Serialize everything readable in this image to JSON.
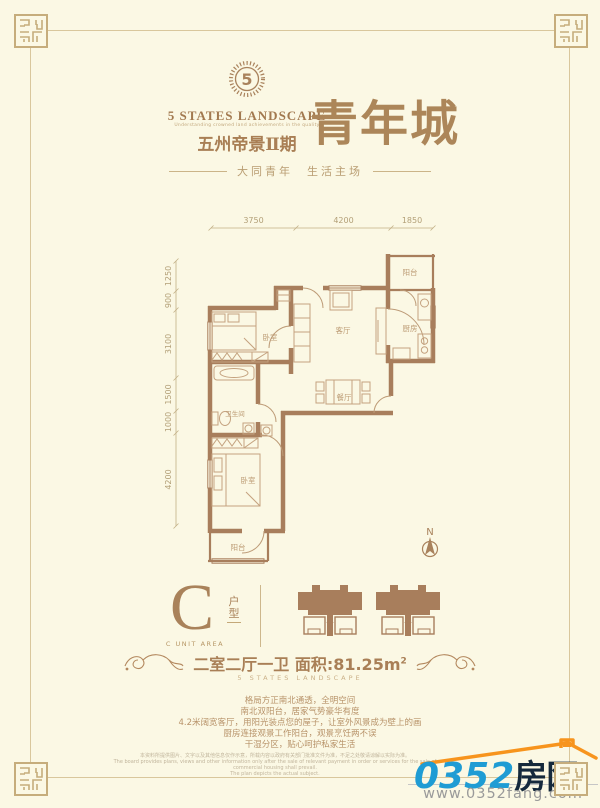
{
  "colors": {
    "background": "#FBF8E4",
    "brand_brown": "#A9825C",
    "wall_brown": "#A87E5C",
    "watermark_blue": "#1F9CD4",
    "watermark_navy": "#15293C",
    "watermark_orange": "#F7941D"
  },
  "header": {
    "logo_glyph": "5",
    "brand": "5 STATES LANDSCAPE",
    "tagline": "Understanding crowned land achievements in the quality",
    "project": "五州帝景Ⅱ期",
    "title": "青年城",
    "subtitle": "大同青年　生活主场"
  },
  "plan": {
    "dims_top": [
      "3750",
      "4200",
      "1850"
    ],
    "dims_left": [
      "1250",
      "900",
      "3100",
      "1500",
      "1000",
      "4200"
    ],
    "rooms": {
      "balcony_top": "阳台",
      "kitchen": "厨房",
      "living": "客厅",
      "bedroom1": "卧室",
      "bath": "卫生间",
      "dining": "餐厅",
      "bedroom2": "卧室",
      "balcony_bottom": "阳台"
    },
    "compass": "N"
  },
  "unit": {
    "letter": "C",
    "type_label": "户型",
    "subtitle": "C UNIT AREA"
  },
  "summary": {
    "spec": "二室二厅一卫",
    "area": "面积:81.25m",
    "area_sup": "2",
    "brand": "5 STATES LANDSCAPE"
  },
  "description": {
    "line1": "格局方正南北通透，全明空间",
    "line2": "南北双阳台，居家气势豪华有度",
    "line3": "4.2米阔宽客厅，用阳光装点您的屋子，让室外风景成为壁上的画",
    "line4": "厨房连接观景工作阳台，观景烹饪两不误",
    "line5": "干湿分区，贴心呵护私家生活"
  },
  "disclaimer": {
    "line1": "本资料所提供图片、文字以及其他信息仅作示意，所载内容以政府有关部门批准文件为准，不足之处敬请谅解以实际为准。",
    "line2": "The board provides plans, views and other information only after the sale of relevant payment in order or services for the sale of commercial housing shall prevail.",
    "line3": "The plan depicts the actual subject."
  },
  "watermark": {
    "number": "0352",
    "name": "房网",
    "url": "www.0352fang.com"
  }
}
